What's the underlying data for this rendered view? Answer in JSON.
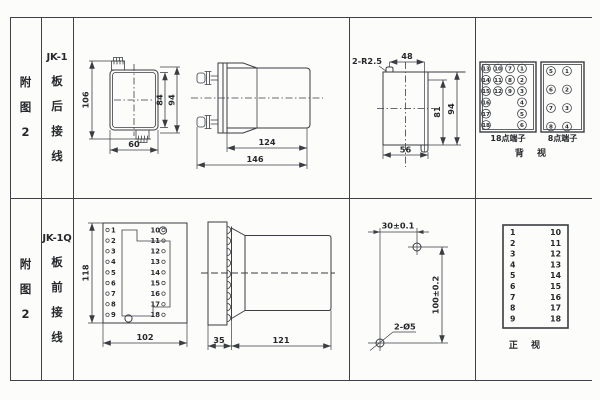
{
  "rows": [
    {
      "fig": "附图2",
      "model": "JK-1",
      "wiring": "板后接线",
      "rear_view": {
        "height": "106",
        "width": "60",
        "inner_height": "84",
        "outer_height": "94"
      },
      "side_view": {
        "body_length": "124",
        "total_length": "146"
      },
      "cutout": {
        "corner_radius": "2-R2.5",
        "slot_offset": "48",
        "inner_height": "81",
        "outer_height": "94",
        "width": "56"
      },
      "terminal18": {
        "label": "18点端子",
        "columns": [
          [
            "13",
            "14",
            "15",
            "16",
            "17",
            "18"
          ],
          [
            "10",
            "11",
            "12"
          ],
          [
            "7",
            "8",
            "9"
          ],
          [
            "1",
            "2",
            "3",
            "4",
            "5",
            "6"
          ]
        ]
      },
      "terminal8": {
        "label": "8点端子",
        "columns": [
          [
            "5",
            "6",
            "7",
            "8"
          ],
          [
            "1",
            "2",
            "3",
            "4"
          ]
        ]
      },
      "view_label": "背 视"
    },
    {
      "fig": "附图2",
      "model": "JK-1Q",
      "wiring": "板前接线",
      "front_plate": {
        "height": "118",
        "width": "102",
        "left_terminals": [
          "1",
          "2",
          "3",
          "4",
          "5",
          "6",
          "7",
          "8",
          "9"
        ],
        "right_terminals": [
          "10",
          "11",
          "12",
          "13",
          "14",
          "15",
          "16",
          "17",
          "18"
        ]
      },
      "side_view": {
        "plate_depth": "35",
        "body_length": "121"
      },
      "drill": {
        "hole_spacing_h": "30±0.1",
        "hole_spacing_v": "100±0.2",
        "hole_label": "2-Ø5"
      },
      "front_view": {
        "label": "正 视",
        "left": [
          "1",
          "2",
          "3",
          "4",
          "5",
          "6",
          "7",
          "8",
          "9"
        ],
        "right": [
          "10",
          "11",
          "12",
          "13",
          "14",
          "15",
          "16",
          "17",
          "18"
        ]
      }
    }
  ]
}
